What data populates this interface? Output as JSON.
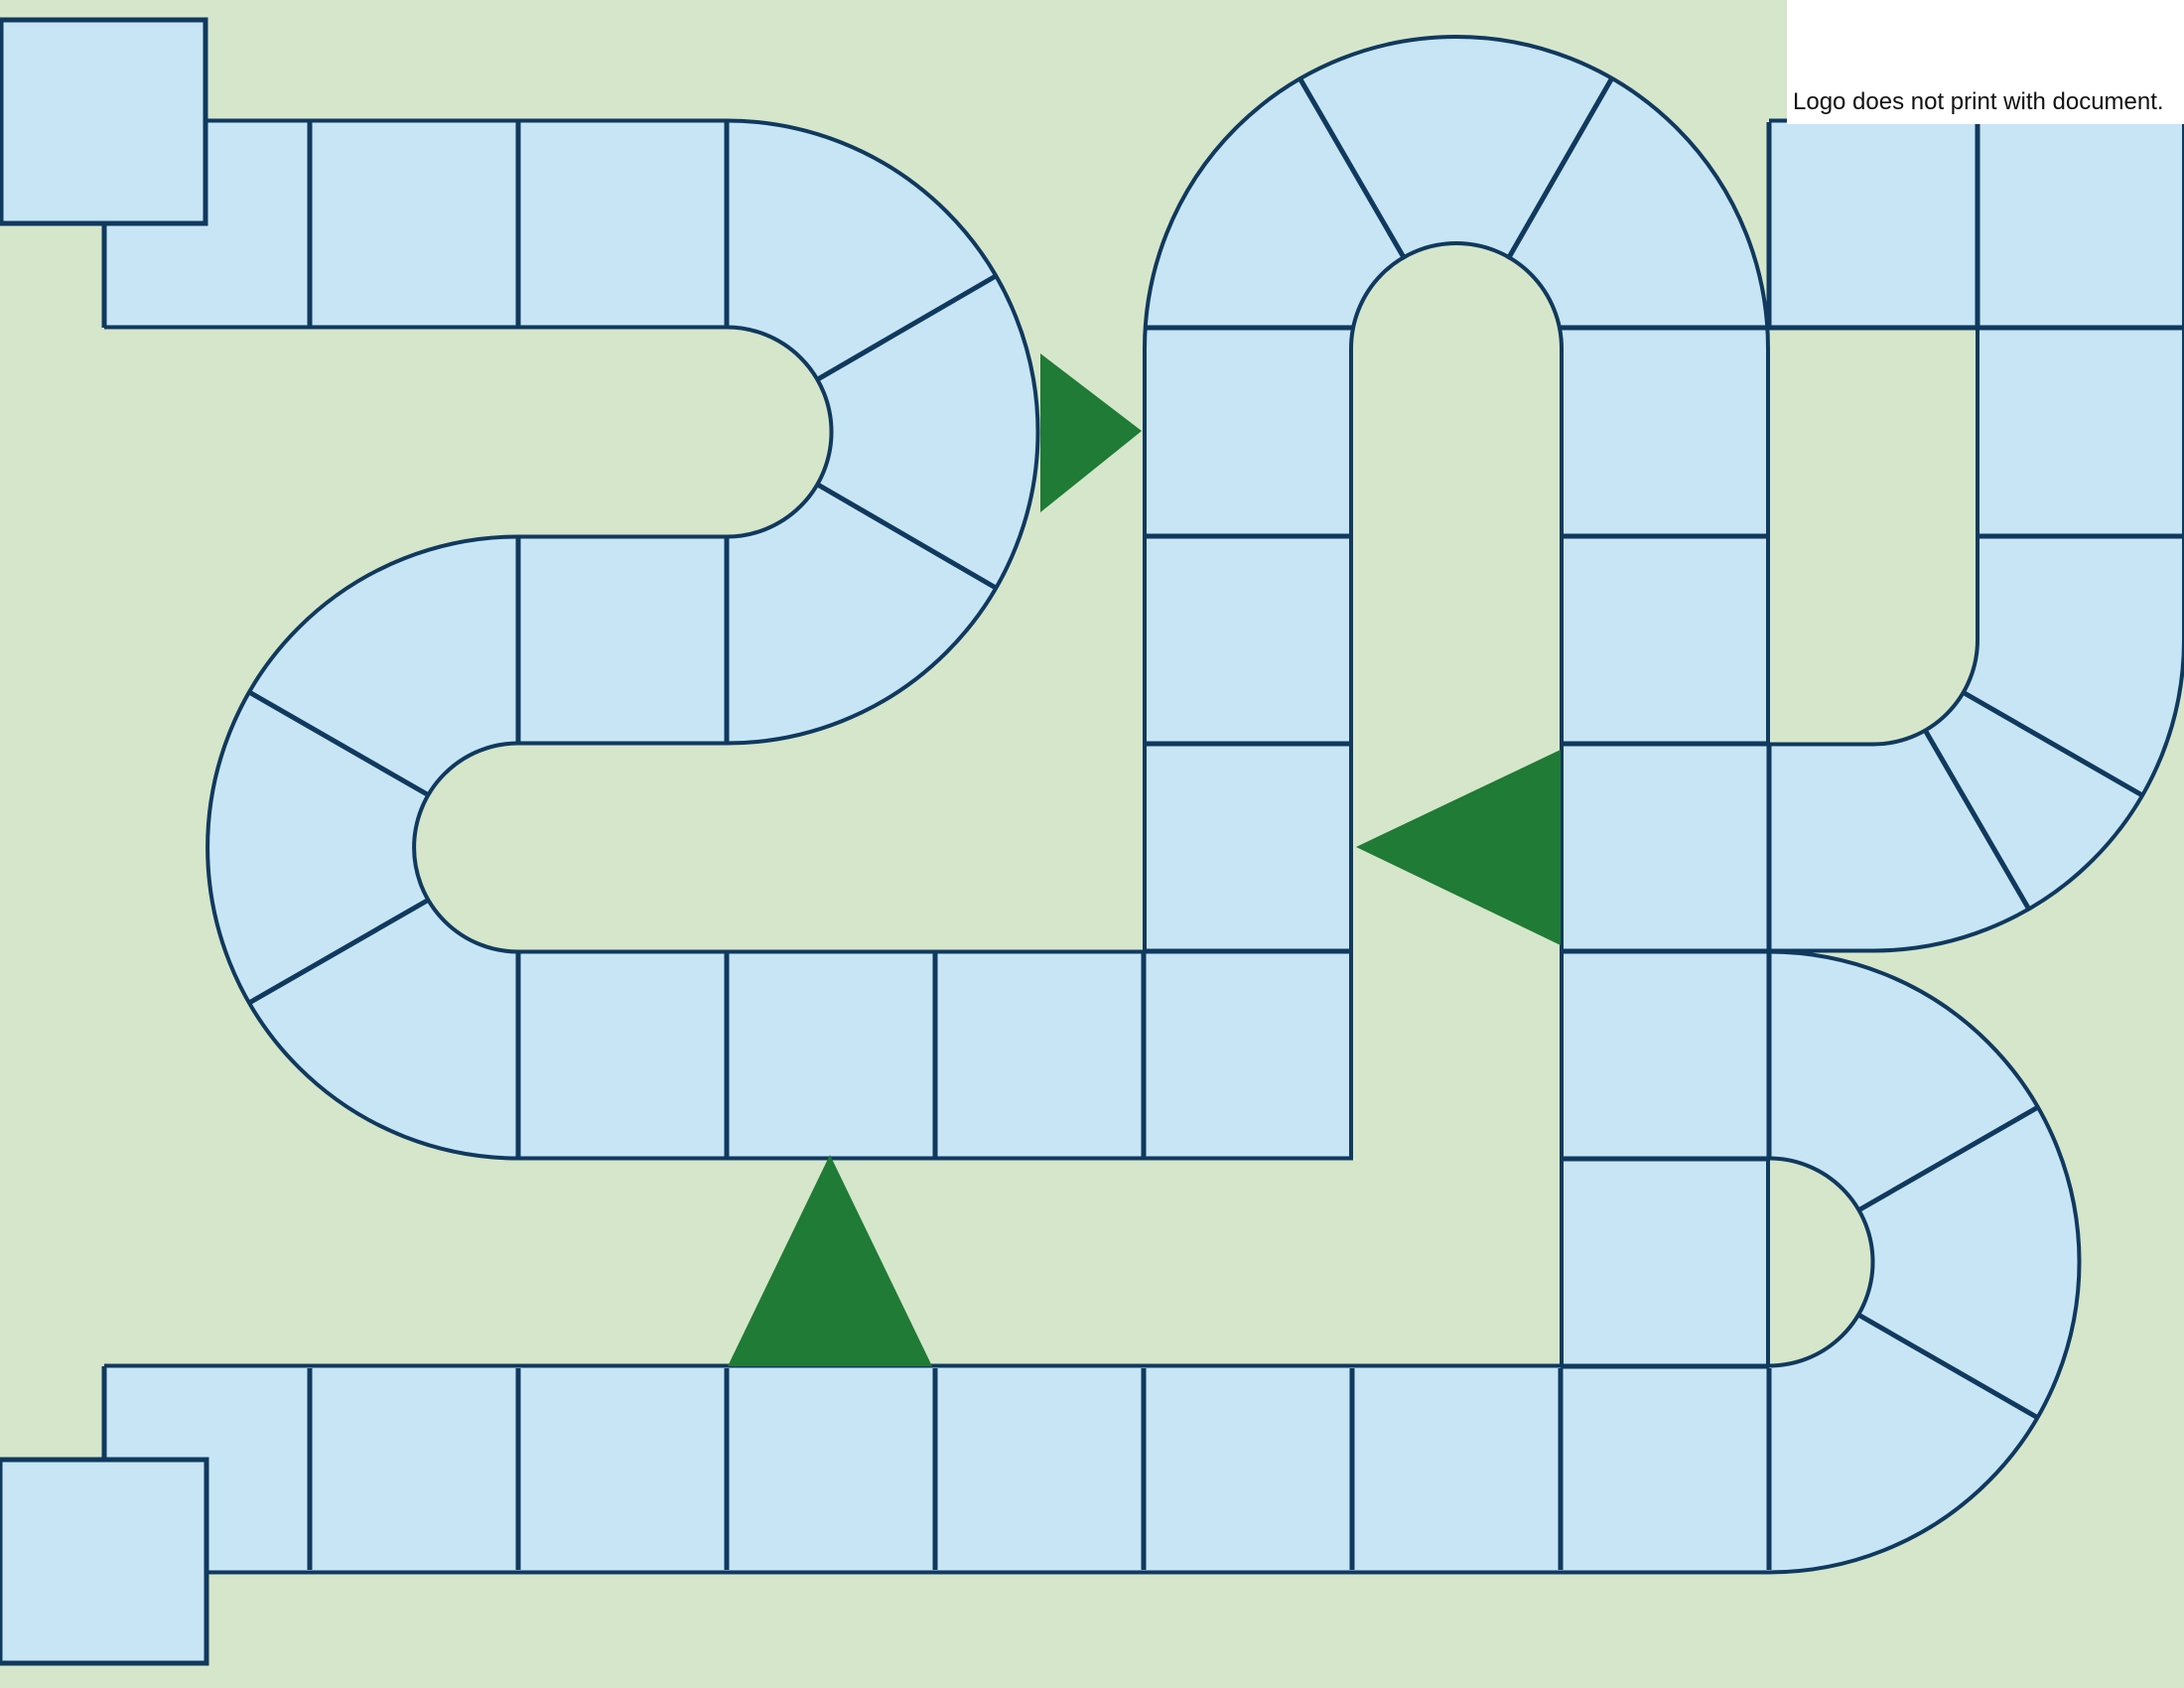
{
  "logo_note": {
    "text": "Logo does not print with document."
  },
  "colors": {
    "background": "#d6e6ca",
    "path_fill": "#c8e5f6",
    "path_border": "#10395e",
    "arrow_green": "#1f7b35",
    "logo_background": "#ffffff",
    "logo_text_color": "#111111"
  },
  "board": {
    "arrows": [
      {
        "icon": "arrow-right-icon",
        "direction": "right"
      },
      {
        "icon": "arrow-left-icon",
        "direction": "left"
      },
      {
        "icon": "arrow-up-icon",
        "direction": "up"
      }
    ]
  }
}
